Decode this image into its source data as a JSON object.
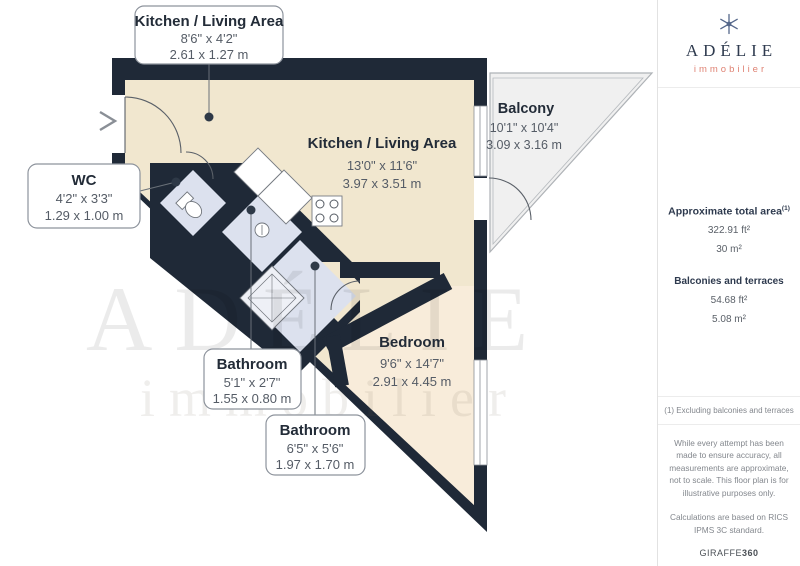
{
  "branding": {
    "logo_text": "ADÉLIE",
    "logo_subtitle": "immobilier",
    "logo_icon": "snowflake",
    "accent_color": "#DF8273",
    "navy_color": "#2F3B4F"
  },
  "watermark": {
    "line1": "ADÉLIE",
    "line2": "immobilier"
  },
  "rooms": [
    {
      "id": "kitchen-callout",
      "name": "Kitchen / Living Area",
      "imperial": "8'6\" x 4'2\"",
      "metric": "2.61 x 1.27 m"
    },
    {
      "id": "kitchen-living",
      "name": "Kitchen / Living Area",
      "imperial": "13'0\" x 11'6\"",
      "metric": "3.97 x 3.51 m"
    },
    {
      "id": "balcony",
      "name": "Balcony",
      "imperial": "10'1\" x 10'4\"",
      "metric": "3.09 x 3.16 m"
    },
    {
      "id": "wc",
      "name": "WC",
      "imperial": "4'2\" x 3'3\"",
      "metric": "1.29 x 1.00 m"
    },
    {
      "id": "bathroom-small",
      "name": "Bathroom",
      "imperial": "5'1\" x 2'7\"",
      "metric": "1.55 x 0.80 m"
    },
    {
      "id": "bathroom-large",
      "name": "Bathroom",
      "imperial": "6'5\" x 5'6\"",
      "metric": "1.97 x 1.70 m"
    },
    {
      "id": "bedroom",
      "name": "Bedroom",
      "imperial": "9'6\" x 14'7\"",
      "metric": "2.91 x 4.45 m"
    }
  ],
  "sidebar": {
    "total_area_label": "Approximate total area",
    "total_area_superscript": "(1)",
    "total_area_ft": "322.91 ft²",
    "total_area_m": "30 m²",
    "balconies_label": "Balconies and terraces",
    "balconies_ft": "54.68 ft²",
    "balconies_m": "5.08 m²",
    "footnote": "(1) Excluding balconies and terraces",
    "disclaimer": "While every attempt has been made to ensure accuracy, all measurements are approximate, not to scale. This floor plan is for illustrative purposes only.",
    "calculation_note": "Calculations are based on RICS IPMS 3C standard.",
    "brand_footer_normal": "GIRAFFE",
    "brand_footer_bold": "360"
  },
  "plan_colors": {
    "wall": "#1F2937",
    "living_floor": "#F1E7CF",
    "bedroom_floor": "#F8ECDA",
    "bathroom_floor": "#DCE1EE",
    "balcony_floor": "#F0F0F0"
  }
}
